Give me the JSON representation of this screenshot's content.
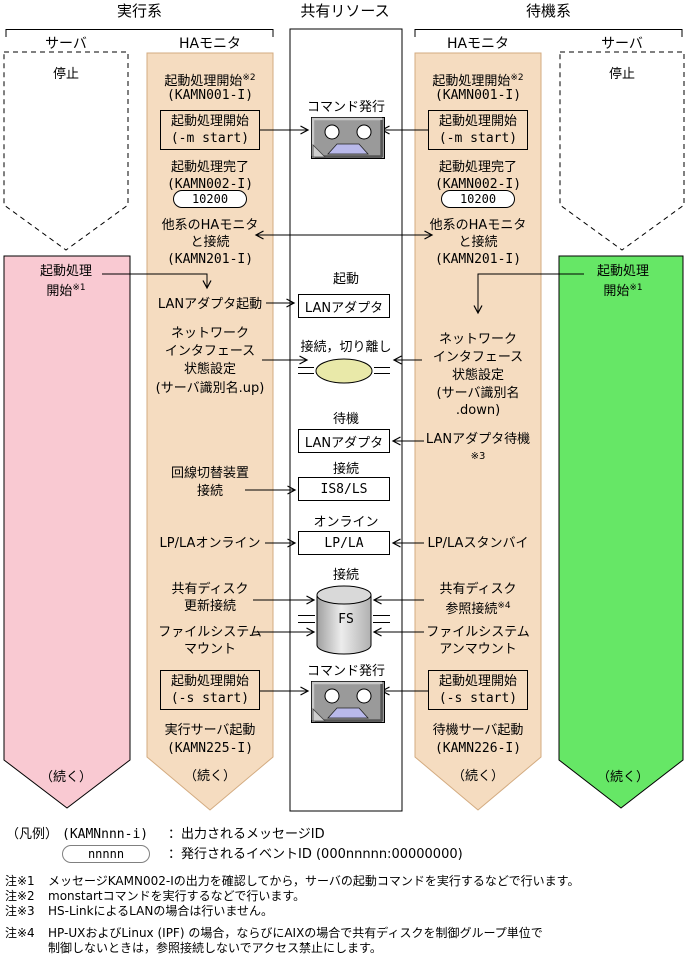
{
  "colors": {
    "ha_column": "#f5dcc0",
    "exec_server_arrow": "#f9c9d2",
    "standby_server_arrow": "#66e766",
    "lan_ellipse": "#e9e9a9",
    "cassette_window": "#b9b9ea",
    "disk_gray": "#d9d9d9"
  },
  "header": {
    "exec": "実行系",
    "shared": "共有リソース",
    "standby": "待機系",
    "server_l": "サーバ",
    "ha_l": "HAモニタ",
    "ha_r": "HAモニタ",
    "server_r": "サーバ"
  },
  "left_server": {
    "stop": "停止",
    "start1": "起動処理",
    "start2": "開始",
    "start_sup": "※1",
    "cont": "（続く）"
  },
  "right_server": {
    "stop": "停止",
    "start1": "起動処理",
    "start2": "開始",
    "start_sup": "※1",
    "cont": "（続く）"
  },
  "left_ha": {
    "p1": "起動処理開始",
    "p1_sup": "※2",
    "p1_id": "(KAMN001-I)",
    "cmd_m1": "起動処理開始",
    "cmd_m2": "(-m start)",
    "p2": "起動処理完了",
    "p2_id": "(KAMN002-I)",
    "event": "10200",
    "p3a": "他系のHAモニタ",
    "p3b": "と接続",
    "p3_id": "(KAMN201-I)",
    "lan": "LANアダプタ起動",
    "net1": "ネットワーク",
    "net2": "インタフェース",
    "net3": "状態設定",
    "net4": "(サーバ識別名.up)",
    "sw1": "回線切替装置",
    "sw2": "接続",
    "lpla": "LP/LAオンライン",
    "disk1": "共有ディスク",
    "disk2": "更新接続",
    "fsm1": "ファイルシステム",
    "fsm2": "マウント",
    "cmd_s1": "起動処理開始",
    "cmd_s2": "(-s start)",
    "p4": "実行サーバ起動",
    "p4_id": "(KAMN225-I)",
    "cont": "（続く）"
  },
  "right_ha": {
    "p1": "起動処理開始",
    "p1_sup": "※2",
    "p1_id": "(KAMN001-I)",
    "cmd_m1": "起動処理開始",
    "cmd_m2": "(-m start)",
    "p2": "起動処理完了",
    "p2_id": "(KAMN002-I)",
    "event": "10200",
    "p3a": "他系のHAモニタ",
    "p3b": "と接続",
    "p3_id": "(KAMN201-I)",
    "net1": "ネットワーク",
    "net2": "インタフェース",
    "net3": "状態設定",
    "net4": "(サーバ識別名",
    "net5": ".down)",
    "lanw": "LANアダプタ待機",
    "lanw_sup": "※3",
    "lpla": "LP/LAスタンバイ",
    "disk1": "共有ディスク",
    "disk2": "参照接続",
    "disk2_sup": "※4",
    "fsm1": "ファイルシステム",
    "fsm2": "アンマウント",
    "cmd_s1": "起動処理開始",
    "cmd_s2": "(-s start)",
    "p4": "待機サーバ起動",
    "p4_id": "(KAMN226-I)",
    "cont": "（続く）"
  },
  "shared": {
    "cmd1": "コマンド発行",
    "boot": "起動",
    "lan1": "LANアダプタ",
    "attach": "接続，切り離し",
    "standby": "待機",
    "lan2": "LANアダプタ",
    "conn1": "接続",
    "line_unit": "IS8/LS",
    "online": "オンライン",
    "lpla": "LP/LA",
    "conn2": "接続",
    "fs": "FS",
    "cmd2": "コマンド発行"
  },
  "legend": {
    "title": "（凡例）",
    "msg_key": "(KAMNnnn-i)",
    "msg_desc": "：出力されるメッセージID",
    "event_key": "nnnnn",
    "event_desc": "：発行されるイベントID (000nnnnn:00000000)"
  },
  "notes": {
    "n1_label": "注※1",
    "n1_text": "メッセージKAMN002-Iの出力を確認してから，サーバの起動コマンドを実行するなどで行います。",
    "n2_label": "注※2",
    "n2_text": "monstartコマンドを実行するなどで行います。",
    "n3_label": "注※3",
    "n3_text": "HS-LinkによるLANの場合は行いません。",
    "n4_label": "注※4",
    "n4_text1": "HP-UXおよびLinux (IPF) の場合，ならびにAIXの場合で共有ディスクを制御グループ単位で",
    "n4_text2": "制御しないときは，参照接続しないでアクセス禁止にします。"
  }
}
